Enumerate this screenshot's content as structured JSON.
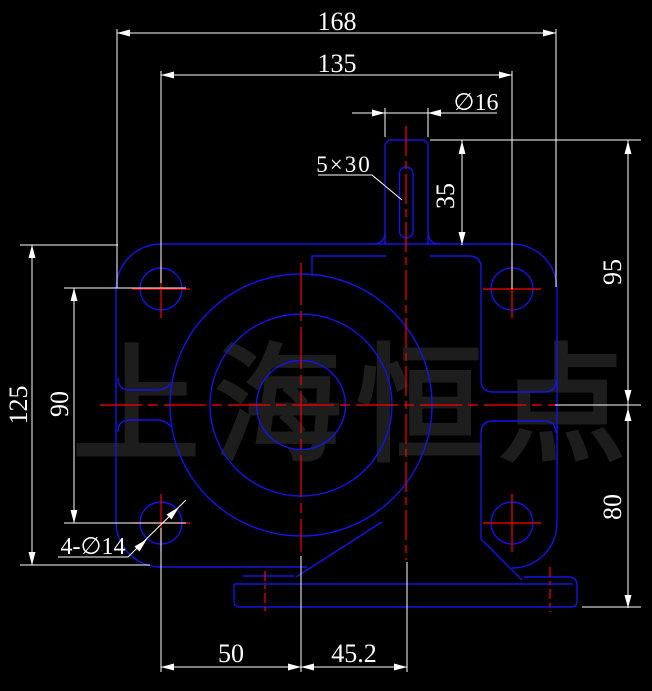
{
  "drawing": {
    "type": "cad-front-view",
    "watermark": {
      "text": "上海恒点"
    },
    "colors": {
      "background": "#000000",
      "geometry_line": "#1414e6",
      "centerline": "#fd0000",
      "dimension_line": "#ffffff",
      "watermark": "#1d1d1d"
    },
    "dimensions": {
      "overall_width": "168",
      "bolt_spacing_horizontal": "135",
      "shaft_diameter": "∅16",
      "keyway": "5×30",
      "shaft_height": "35",
      "upper_height": "95",
      "lower_height": "80",
      "overall_height": "125",
      "bolt_spacing_vertical": "90",
      "bolt_holes": "4-∅14",
      "base_offset_left": "50",
      "base_offset_right": "45.2"
    }
  }
}
